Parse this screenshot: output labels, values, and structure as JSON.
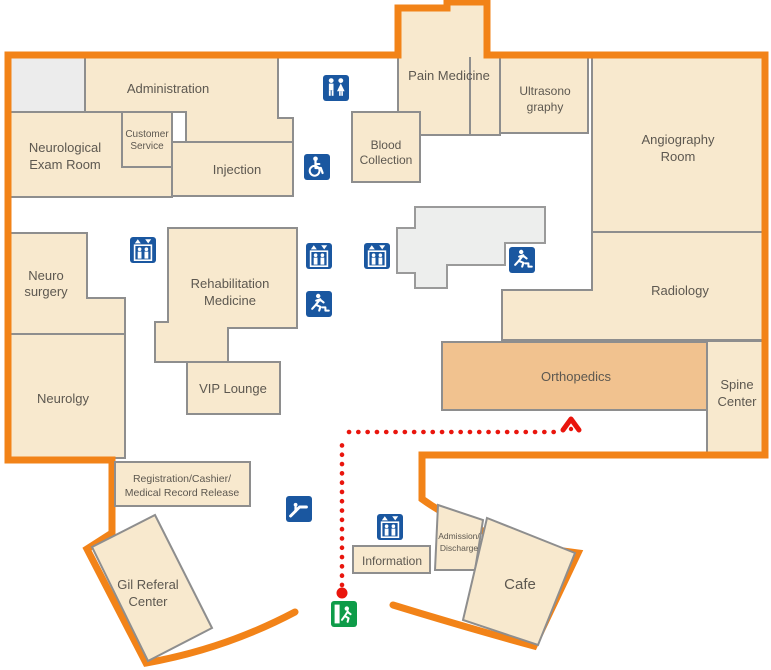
{
  "rooms": {
    "administration": {
      "label": "Administration"
    },
    "neurological_exam_room": {
      "lines": [
        "Neurological",
        "Exam Room"
      ]
    },
    "customer_service": {
      "lines": [
        "Customer",
        "Service"
      ]
    },
    "injection": {
      "label": "Injection"
    },
    "pain_medicine": {
      "label": "Pain Medicine"
    },
    "blood_collection": {
      "lines": [
        "Blood",
        "Collection"
      ]
    },
    "ultrasonography": {
      "lines": [
        "Ultrasono",
        "graphy"
      ]
    },
    "angiography_room": {
      "lines": [
        "Angiography",
        "Room"
      ]
    },
    "neuro_surgery": {
      "lines": [
        "Neuro",
        "surgery"
      ]
    },
    "rehabilitation_medicine": {
      "lines": [
        "Rehabilitation",
        "Medicine"
      ]
    },
    "radiology": {
      "label": "Radiology"
    },
    "vip_lounge": {
      "label": "VIP Lounge"
    },
    "neurology": {
      "label": "Neurolgy"
    },
    "orthopedics": {
      "label": "Orthopedics"
    },
    "spine_center": {
      "lines": [
        "Spine",
        "Center"
      ]
    },
    "registration_cashier": {
      "lines": [
        "Registration/Cashier/",
        "Medical Record Release"
      ]
    },
    "gil_referal_center": {
      "lines": [
        "Gil Referal",
        "Center"
      ]
    },
    "information": {
      "label": "Information"
    },
    "admission_discharge": {
      "lines": [
        "Admission/",
        "Discharge"
      ]
    },
    "cafe": {
      "label": "Cafe"
    }
  },
  "icons": [
    "restroom-icon",
    "wheelchair-accessible-icon",
    "elevator-icon",
    "emergency-exit-icon",
    "escalator-icon",
    "exit-door-icon"
  ],
  "route": {
    "style": "dotted",
    "points_to": "Orthopedics"
  },
  "colors": {
    "outline_orange": "#F28318",
    "room_fill": "#F8E9CE",
    "room_border": "#8E8E8E",
    "highlight_fill": "#F1C28F",
    "gray_room_fill": "#ECECEC",
    "gray_area_fill": "#EDEEED",
    "icon_blue": "#1A57A0",
    "exit_green": "#0E9C49",
    "route_red": "#E9150D",
    "label_text": "#5D5850"
  }
}
